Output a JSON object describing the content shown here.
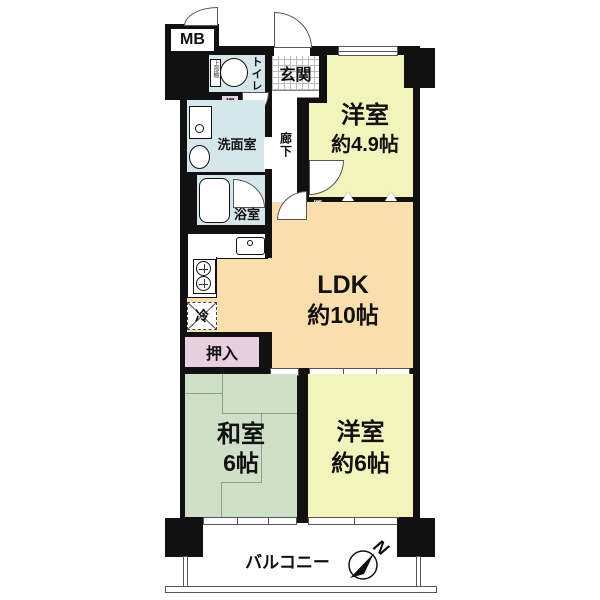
{
  "mb": {
    "label": "MB"
  },
  "entrance": {
    "label": "玄関"
  },
  "toilet": {
    "label": "トイレ",
    "upper_shelf": "上部棚",
    "shelf": "棚"
  },
  "washroom": {
    "label": "洗面室"
  },
  "bathroom": {
    "label": "浴室"
  },
  "corridor": {
    "label": "廊下"
  },
  "western_room_1": {
    "label": "洋室",
    "size": "約4.9帖",
    "shelf": "棚"
  },
  "storage_1": {
    "label": "物入"
  },
  "storage_2": {
    "label": "物入"
  },
  "ldk": {
    "label": "LDK",
    "size": "約10帖"
  },
  "kitchen": {
    "fridge": "冷"
  },
  "oshiire": {
    "label": "押入"
  },
  "japanese_room": {
    "label": "和室",
    "size": "6帖"
  },
  "western_room_2": {
    "label": "洋室",
    "size": "約6帖"
  },
  "balcony": {
    "label": "バルコニー"
  },
  "compass": {
    "north": "N"
  },
  "colors": {
    "wall": "#111111",
    "western_room": "#f2f4bc",
    "ldk": "#fadfad",
    "tatami_room": "#cfe0c8",
    "wet_area": "#d6e7ec",
    "storage": "#e7cfdf"
  }
}
